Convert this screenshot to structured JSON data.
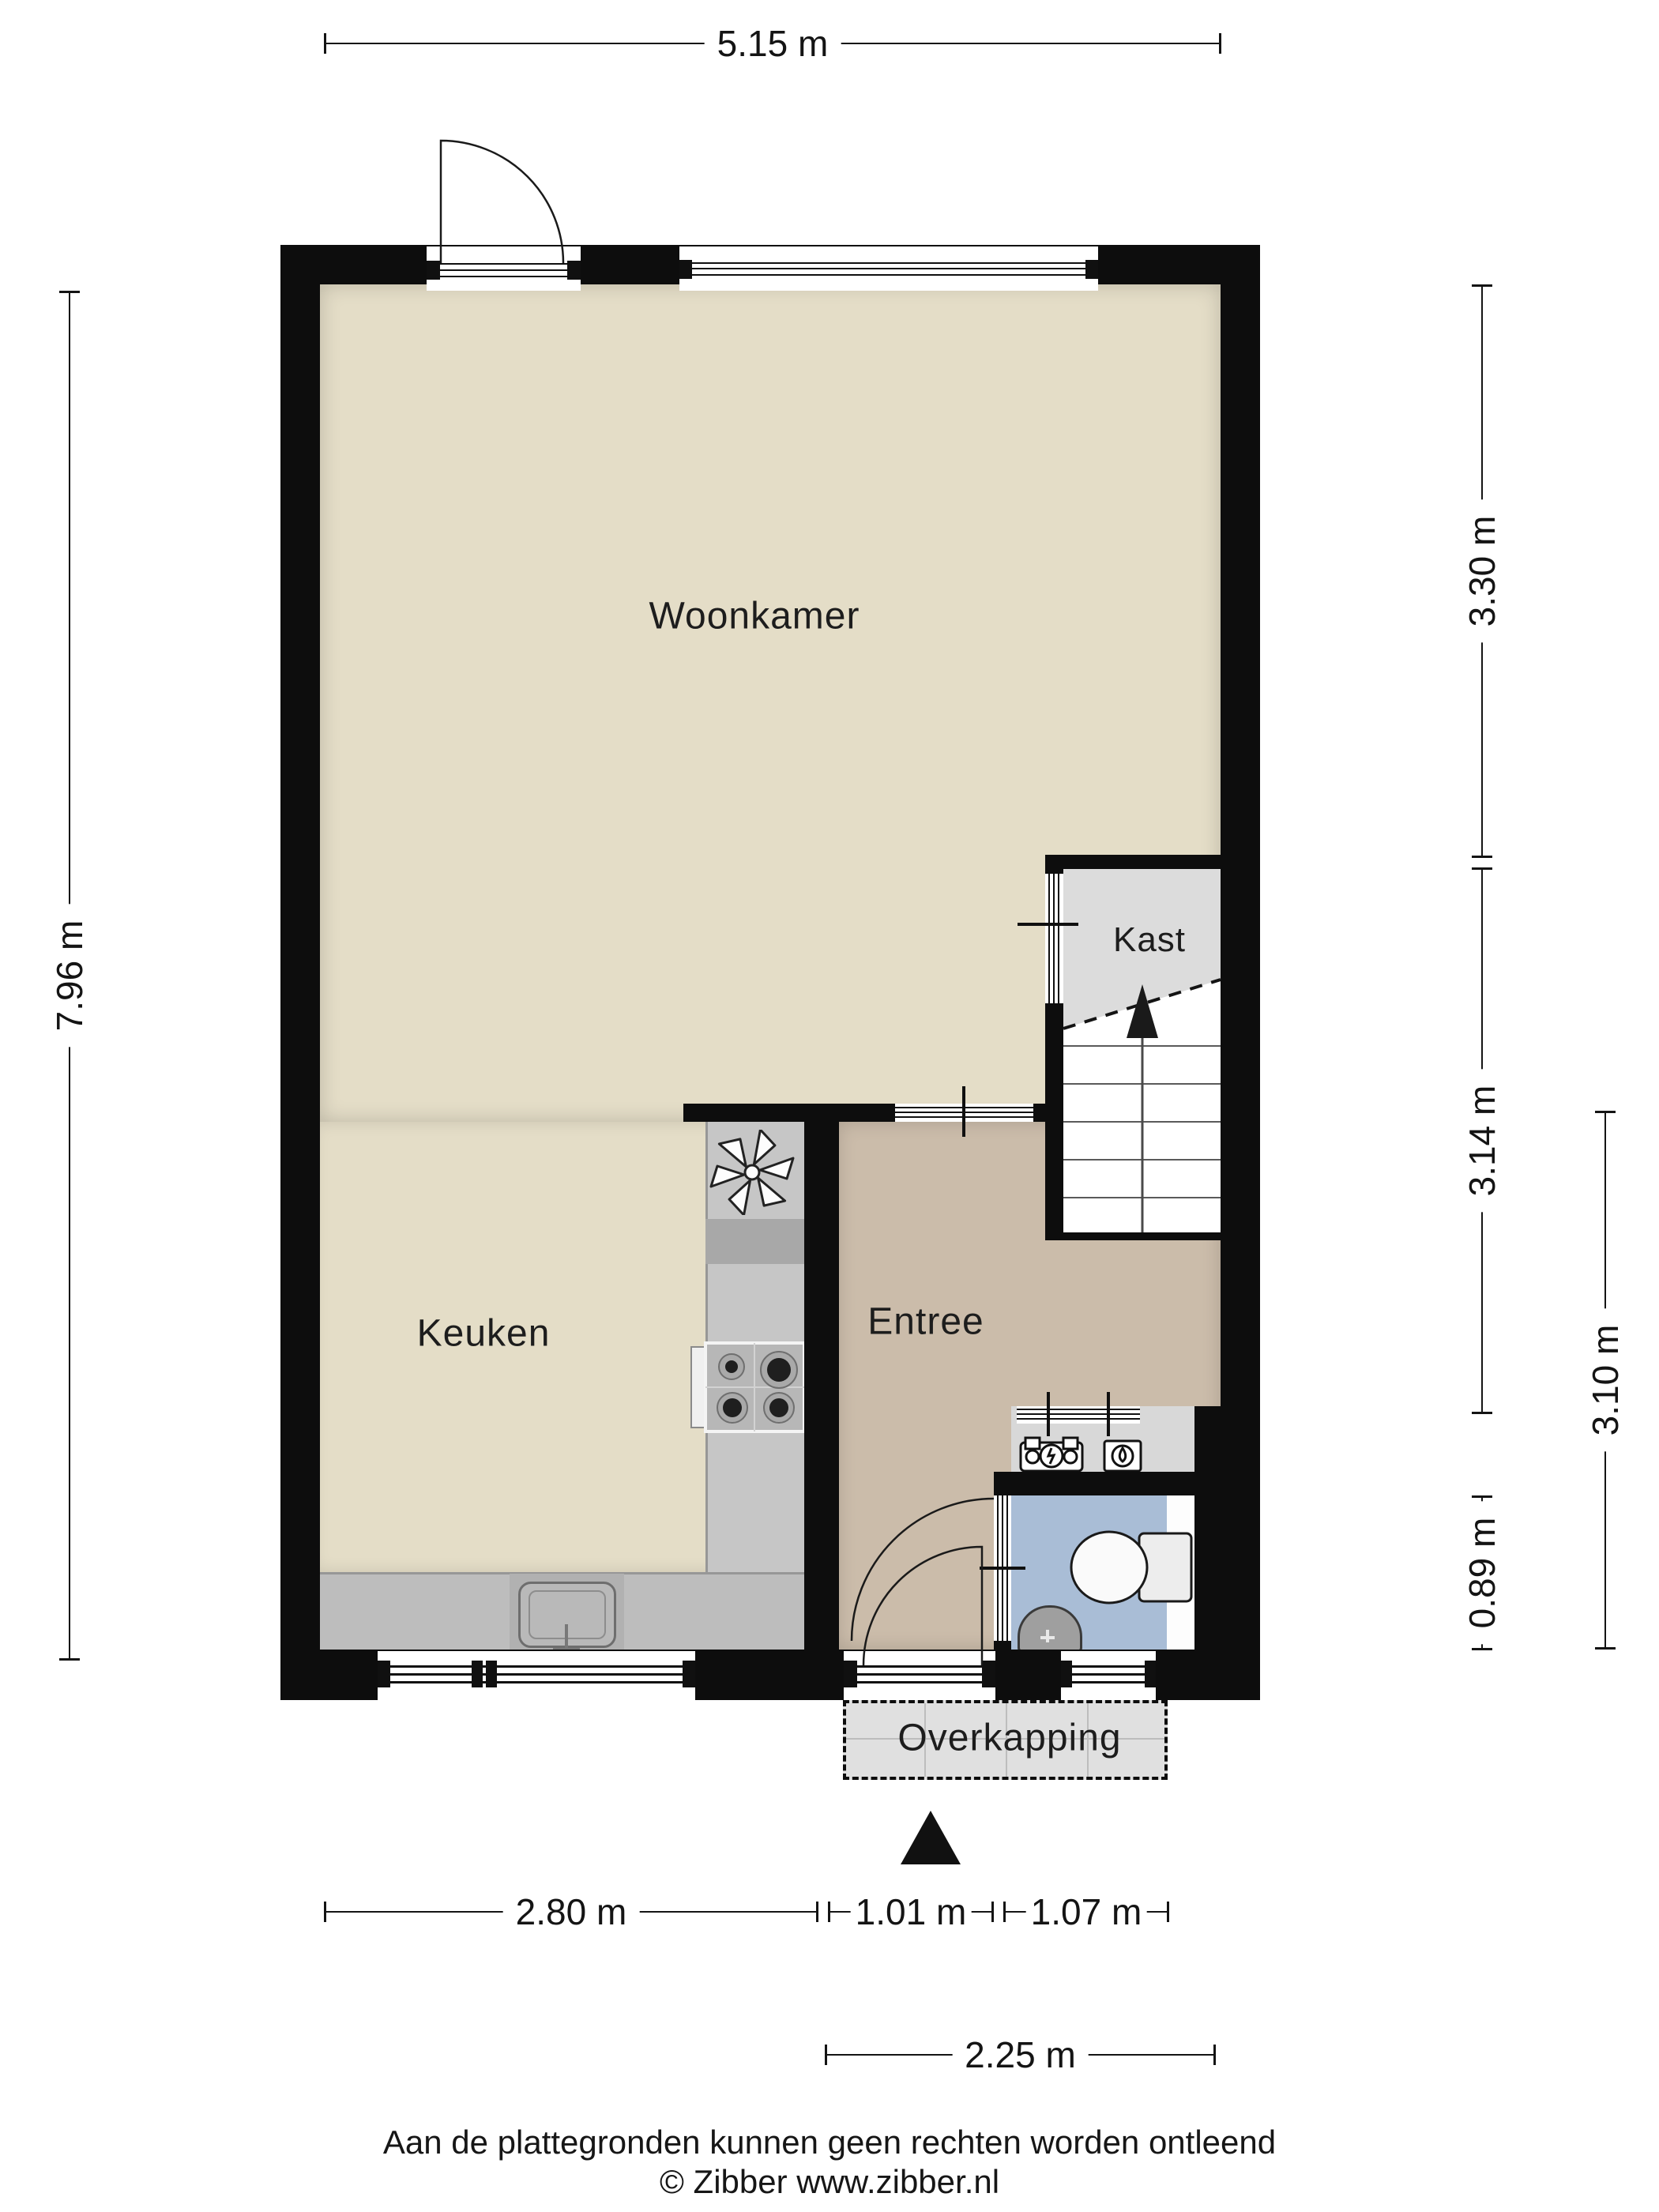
{
  "rooms": {
    "woonkamer": "Woonkamer",
    "keuken": "Keuken",
    "entree": "Entree",
    "kast": "Kast",
    "overkapping": "Overkapping"
  },
  "dimensions": {
    "top_width": "5.15 m",
    "left_height": "7.96 m",
    "right_upper": "3.30 m",
    "right_middle": "3.14 m",
    "right_toilet": "0.89 m",
    "right_inner": "3.10 m",
    "bottom_keuken": "2.80 m",
    "bottom_entree": "1.01 m",
    "bottom_right": "1.07 m",
    "bottom_overkapping": "2.25 m"
  },
  "footer": {
    "disclaimer": "Aan de plattegronden kunnen geen rechten worden ontleend",
    "credit": "© Zibber www.zibber.nl"
  },
  "icons": {
    "north_arrow": "north-arrow",
    "stairs": "staircase-up-arrow",
    "toilet": "toilet",
    "washbasin": "washbasin",
    "stove": "four-burner-stove",
    "oven_handle": "oven-handle",
    "sink": "kitchen-sink",
    "extractor": "extractor-fan",
    "meter_left": "electric-meter",
    "meter_right": "water-heater",
    "doors": "door-swing"
  },
  "colors": {
    "wall": "#0d0d0d",
    "floor-main": "#e4ddc7",
    "floor-entree": "#cbbcaa",
    "floor-kast": "#dcdcdc",
    "floor-toilet": "#a9bdd6",
    "floor-niche": "#d8d8d8",
    "counter": "#c6c6c6",
    "counter-dark": "#a8a8a8",
    "overkapping": "#e0e0e0"
  }
}
